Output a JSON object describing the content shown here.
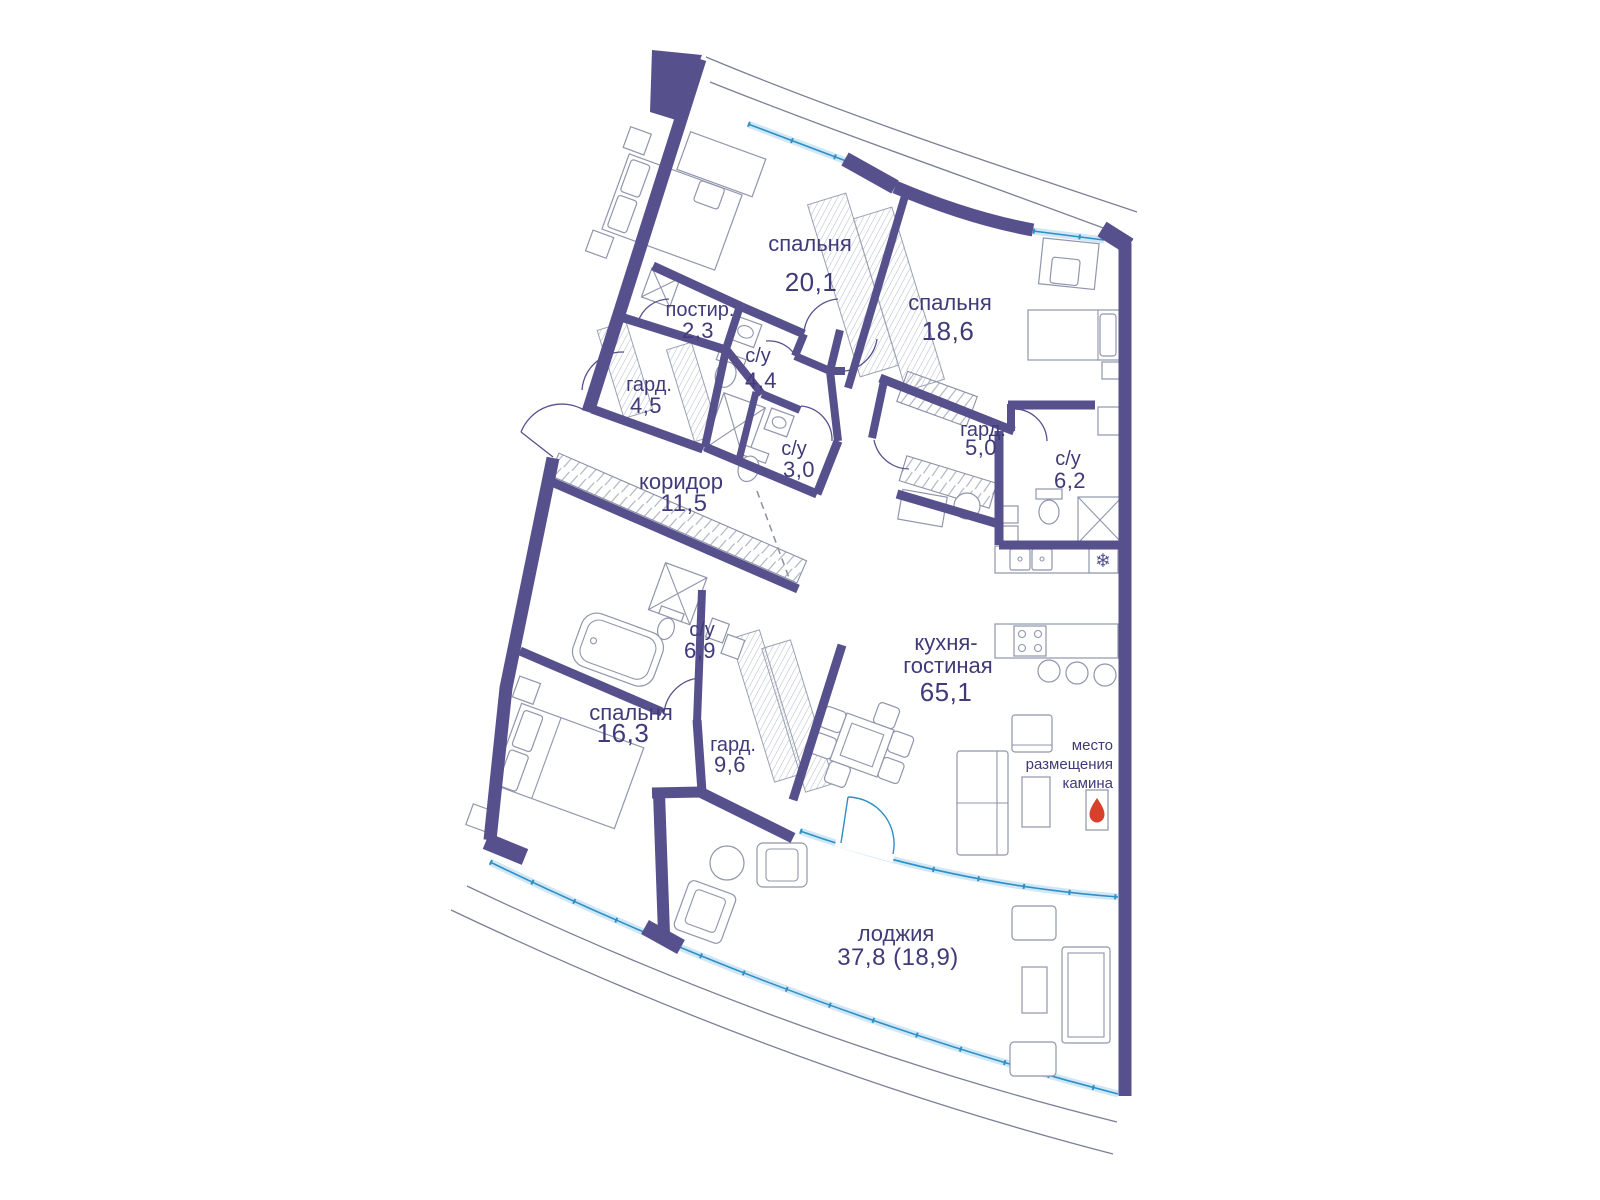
{
  "plan": {
    "language": "ru",
    "rooms": [
      {
        "key": "bedroom-1",
        "name": "спальня",
        "area": "20,1"
      },
      {
        "key": "bedroom-2",
        "name": "спальня",
        "area": "18,6"
      },
      {
        "key": "laundry",
        "name": "постир.",
        "area": "2,3"
      },
      {
        "key": "bathroom-1",
        "name": "с/у",
        "area": "4,4"
      },
      {
        "key": "wardrobe-1",
        "name": "гард.",
        "area": "4,5"
      },
      {
        "key": "bathroom-2",
        "name": "с/у",
        "area": "3,0"
      },
      {
        "key": "corridor",
        "name": "коридор",
        "area": "11,5"
      },
      {
        "key": "wardrobe-2",
        "name": "гард.",
        "area": "5,0"
      },
      {
        "key": "bathroom-3",
        "name": "с/у",
        "area": "6,2"
      },
      {
        "key": "bathroom-4",
        "name": "с/у",
        "area": "6,9"
      },
      {
        "key": "bedroom-3",
        "name": "спальня",
        "area": "16,3"
      },
      {
        "key": "wardrobe-3",
        "name": "гард.",
        "area": "9,6"
      },
      {
        "key": "kitchen-living",
        "name": "кухня-гостиная",
        "name_line1": "кухня-",
        "name_line2": "гостиная",
        "area": "65,1"
      },
      {
        "key": "loggia",
        "name": "лоджия",
        "area": "37,8 (18,9)"
      }
    ],
    "fireplace_note": {
      "line1": "место",
      "line2": "размещения",
      "line3": "камина"
    },
    "symbols": {
      "fridge_snowflake": "❄"
    },
    "colors": {
      "walls": "#56518D",
      "windows": "#2E8FC4",
      "glass": "#CFE7F6",
      "text": "#403A78",
      "furniture": "#9095AB",
      "hatch": "#B9BDCB",
      "flame": "#D9402C"
    }
  }
}
